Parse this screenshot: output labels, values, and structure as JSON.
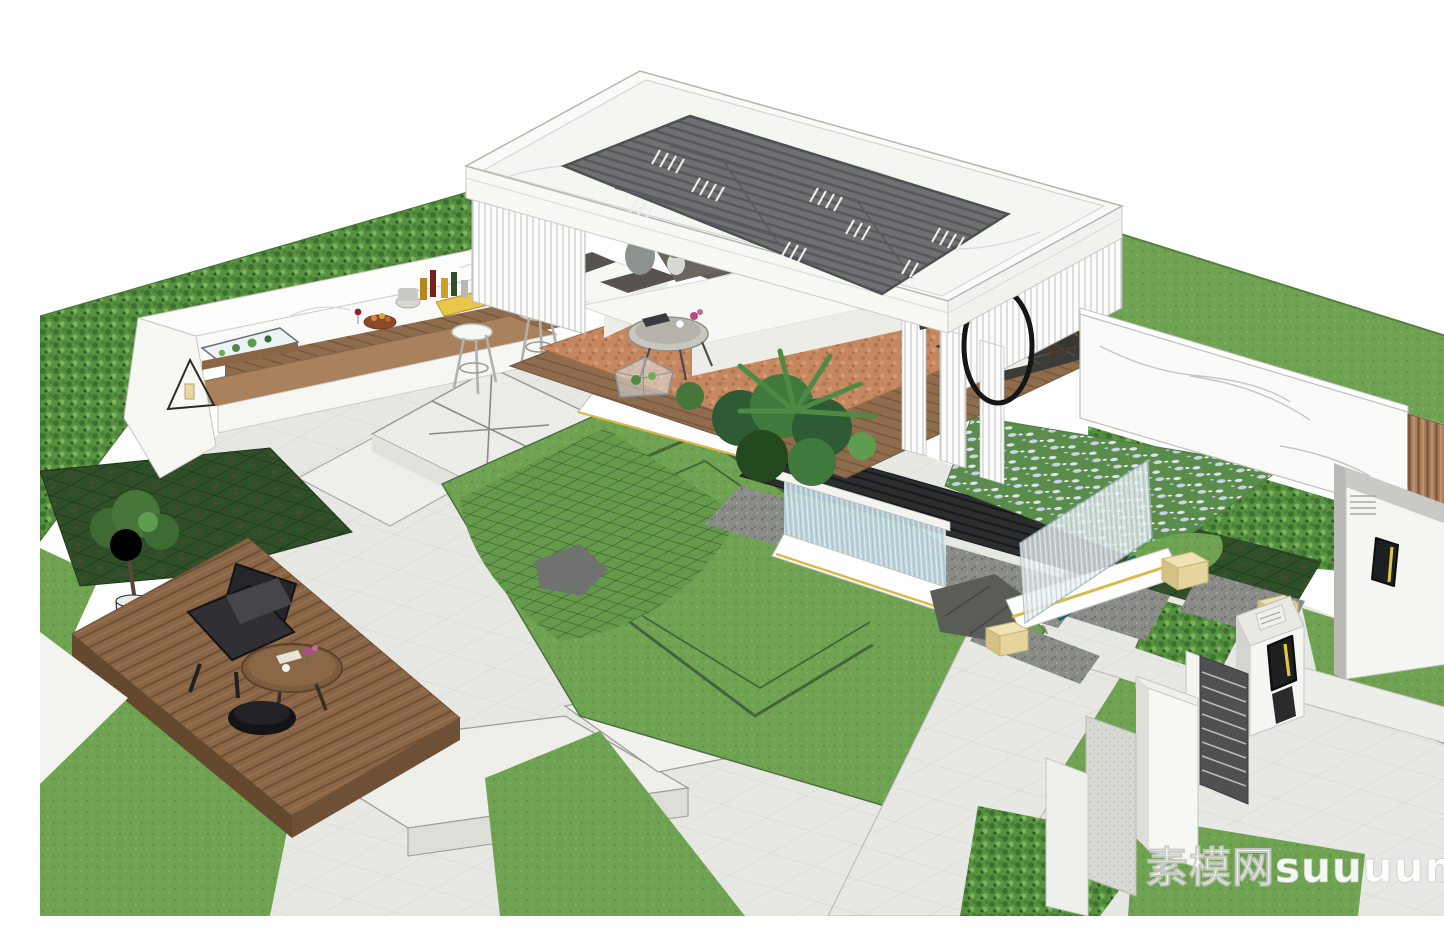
{
  "canvas": {
    "width": 1444,
    "height": 900
  },
  "watermark": {
    "text": "素模网suuuum.com"
  },
  "palette": {
    "bg": "#ffffff",
    "lawn": "#6FA352",
    "lawn_line": "#44633A",
    "hedge": "#569140",
    "hedge_dark": "#3F7030",
    "hedge_light": "#79B65B",
    "dark_plot": "#2F4F28",
    "deck_wood": "#8A6647",
    "deck_wood_dark": "#6E5037",
    "floor_terracotta": "#C4875F",
    "paving": "#E7E7E3",
    "paving_edge": "#A9A9A5",
    "paving_raised": "#ECECE8",
    "gravel": "#8A8C88",
    "marble": "#FAFAF8",
    "marble_line": "#C4C6C7",
    "louver": "#6E7072",
    "louver_dark": "#55575A",
    "water_glass": "#C3DDE6",
    "water_teal": "#20768A",
    "gold": "#D8B94A",
    "black_slat": "#2B2D2F",
    "wood_fence": "#A87E5C",
    "sofa": "#F7F7F4",
    "cushion": "#57534F",
    "chair": "#26262A",
    "table_wood": "#7C5C3C",
    "flower_bed": "#5A8C4C",
    "flower": "#CBD2E8",
    "cube": "#E5D49C",
    "gate_gray": "#D8D8D3",
    "sconce": "#1E1F21",
    "sconce_yellow": "#E2C63F",
    "white": "#FFFFFF",
    "watermark_color": "#FFFFFF"
  },
  "scene": {
    "kind": "3D landscape design render (SketchUp style), isometric courtyard garden",
    "objects": [
      {
        "name": "tall-hedge-wall",
        "label": "green hedge boundary wall, upper left"
      },
      {
        "name": "outdoor-bar-counter",
        "label": "white marble bar with wood cabinet, bottles, fruit bowl, lanterns, terrarium, two bar stools"
      },
      {
        "name": "pavilion",
        "label": "flat white marble roof pavilion with dark louvered skylight and vertical slat screens"
      },
      {
        "name": "pavilion-lounge",
        "label": "white L sofa with charcoal cushions, round coffee table, lattice side table with lantern, terracotta floor, tropical plants, hanging ring chair"
      },
      {
        "name": "water-feature",
        "label": "black slatted deck with glass waterfall, gravel bed and boulder"
      },
      {
        "name": "flower-bed",
        "label": "hydrangea bed in rows with translucent ribbed glass screen and teal water channel"
      },
      {
        "name": "main-lawn",
        "label": "central lawn with grass-paver mesh area, rock and dark border inlays"
      },
      {
        "name": "wood-deck",
        "label": "timber deck with black lounge chair, oval table, pouf and bonsai planter"
      },
      {
        "name": "paving",
        "label": "light gray stone paving, raised platforms, steps and diagonal walks"
      },
      {
        "name": "entry-gate",
        "label": "white gate pillars, dark louvered door, intercom with yellow slot"
      },
      {
        "name": "side-walls",
        "label": "white marble wall, vertical wood slat fence, white panel with black sconce"
      },
      {
        "name": "yellow-cube-stools",
        "label": "translucent beige cube seats"
      }
    ]
  }
}
